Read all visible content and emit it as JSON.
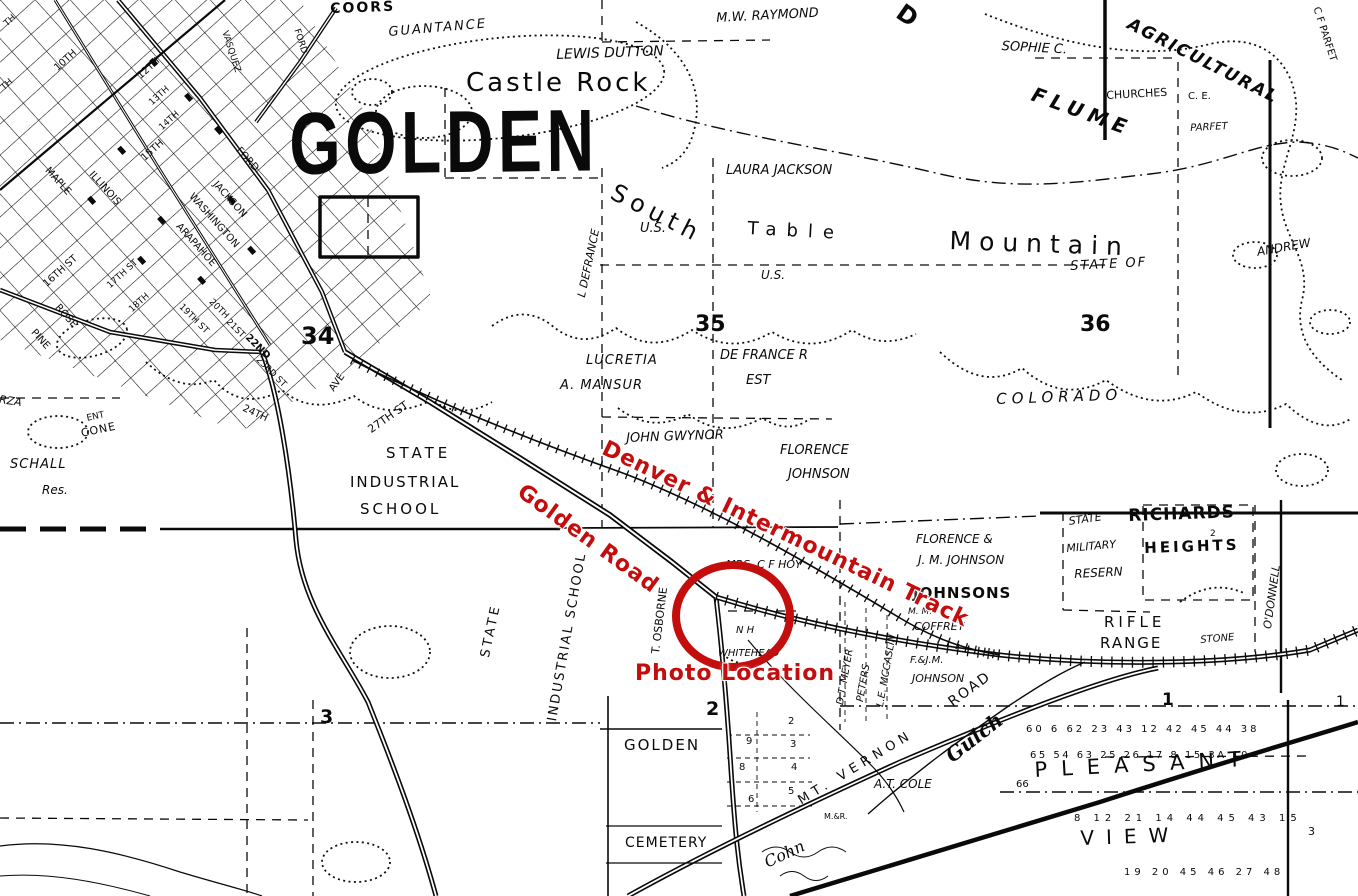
{
  "page": {
    "width": 1358,
    "height": 896,
    "background": "#ffffff",
    "ink": "#0a0a0a",
    "annotation_red": "#c40d0d"
  },
  "stamp": {
    "text": "GOLDEN"
  },
  "red_annotations": {
    "track": "Denver & Intermountain Track",
    "road": "Golden Road",
    "photo": "Photo Location",
    "circle": {
      "cx": 733,
      "cy": 616,
      "rx": 57,
      "ry": 51,
      "stroke_width": 8
    }
  },
  "labels": [
    {
      "t": "COORS",
      "x": 330,
      "y": 2,
      "s": 14,
      "w": 700,
      "ls": 2,
      "r": -2
    },
    {
      "t": "FORD",
      "x": 300,
      "y": 28,
      "s": 9,
      "r": 72
    },
    {
      "t": "VASQUEZ",
      "x": 228,
      "y": 30,
      "s": 9,
      "r": 72
    },
    {
      "t": "GUANTANCE",
      "x": 388,
      "y": 26,
      "s": 13,
      "i": 1,
      "ls": 2,
      "r": -5
    },
    {
      "t": "LEWIS DUTTON",
      "x": 556,
      "y": 48,
      "s": 14,
      "i": 1,
      "r": -2
    },
    {
      "t": "Castle Rock",
      "x": 466,
      "y": 70,
      "s": 26,
      "ls": 3
    },
    {
      "t": "M.W. RAYMOND",
      "x": 716,
      "y": 12,
      "s": 13,
      "i": 1,
      "r": -3
    },
    {
      "t": "SOPHIE C.",
      "x": 1002,
      "y": 40,
      "s": 13,
      "i": 1,
      "r": 3
    },
    {
      "t": "AGRICULTURAL",
      "x": 1132,
      "y": 16,
      "s": 17,
      "w": 600,
      "ls": 2,
      "i": 1,
      "r": 27
    },
    {
      "t": "FLUME",
      "x": 1036,
      "y": 84,
      "s": 20,
      "w": 700,
      "ls": 6,
      "i": 1,
      "r": 20
    },
    {
      "t": "CHURCHES",
      "x": 1106,
      "y": 90,
      "s": 11,
      "r": -3
    },
    {
      "t": "C. E.",
      "x": 1188,
      "y": 92,
      "s": 10
    },
    {
      "t": "PARFET",
      "x": 1190,
      "y": 124,
      "s": 10,
      "i": 1,
      "r": -3
    },
    {
      "t": "C F PARFET",
      "x": 1320,
      "y": 6,
      "s": 10,
      "r": 72
    },
    {
      "t": "D",
      "x": 906,
      "y": 0,
      "s": 24,
      "w": 700,
      "r": 35
    },
    {
      "t": "TH",
      "x": 3,
      "y": 22,
      "s": 9,
      "r": -42
    },
    {
      "t": "TH",
      "x": 0,
      "y": 86,
      "s": 9,
      "r": -42
    },
    {
      "t": "10TH",
      "x": 53,
      "y": 66,
      "s": 10,
      "r": -42
    },
    {
      "t": "12TH",
      "x": 136,
      "y": 74,
      "s": 10,
      "r": -42
    },
    {
      "t": "13TH",
      "x": 148,
      "y": 101,
      "s": 9,
      "r": -42
    },
    {
      "t": "14TH",
      "x": 158,
      "y": 126,
      "s": 9,
      "r": -42
    },
    {
      "t": "15TH",
      "x": 140,
      "y": 156,
      "s": 10,
      "r": -42
    },
    {
      "t": "MAPLE",
      "x": 50,
      "y": 166,
      "s": 10,
      "r": 48
    },
    {
      "t": "ILLINOIS",
      "x": 94,
      "y": 170,
      "s": 10,
      "r": 48
    },
    {
      "t": "WASHINGTON",
      "x": 194,
      "y": 192,
      "s": 10,
      "r": 48
    },
    {
      "t": "ARAPAHOE",
      "x": 181,
      "y": 222,
      "s": 10,
      "r": 48
    },
    {
      "t": "JACKSON",
      "x": 218,
      "y": 180,
      "s": 10,
      "r": 48
    },
    {
      "t": "FORD",
      "x": 241,
      "y": 146,
      "s": 10,
      "r": 48
    },
    {
      "t": "16TH ST",
      "x": 42,
      "y": 282,
      "s": 10,
      "r": -42
    },
    {
      "t": "17TH ST",
      "x": 106,
      "y": 284,
      "s": 9,
      "r": -42
    },
    {
      "t": "18TH",
      "x": 128,
      "y": 308,
      "s": 9,
      "r": -42
    },
    {
      "t": "ROSE",
      "x": 60,
      "y": 303,
      "s": 10,
      "r": 48
    },
    {
      "t": "PINE",
      "x": 36,
      "y": 328,
      "s": 10,
      "r": 48
    },
    {
      "t": "19TH ST",
      "x": 183,
      "y": 303,
      "s": 9,
      "r": 45
    },
    {
      "t": "20TH",
      "x": 213,
      "y": 298,
      "s": 9,
      "r": 45
    },
    {
      "t": "21ST",
      "x": 230,
      "y": 318,
      "s": 9,
      "r": 45
    },
    {
      "t": "22ND",
      "x": 250,
      "y": 333,
      "s": 10,
      "w": 600,
      "r": 45
    },
    {
      "t": "23RD ST",
      "x": 260,
      "y": 356,
      "s": 9,
      "r": 45
    },
    {
      "t": "24TH",
      "x": 245,
      "y": 404,
      "s": 10,
      "r": 25
    },
    {
      "t": "AVE",
      "x": 328,
      "y": 388,
      "s": 10,
      "r": -55
    },
    {
      "t": "27TH ST",
      "x": 366,
      "y": 426,
      "s": 11,
      "r": -35
    },
    {
      "t": "34",
      "x": 301,
      "y": 324,
      "s": 24,
      "w": 700
    },
    {
      "t": "SCHALL",
      "x": 10,
      "y": 458,
      "s": 13,
      "i": 1,
      "ls": 1
    },
    {
      "t": "Res.",
      "x": 42,
      "y": 484,
      "s": 12,
      "i": 1
    },
    {
      "t": "RZA",
      "x": 0,
      "y": 394,
      "s": 11,
      "i": 1,
      "r": 8
    },
    {
      "t": "ENT",
      "x": 86,
      "y": 415,
      "s": 9,
      "r": -12
    },
    {
      "t": "CONE",
      "x": 80,
      "y": 428,
      "s": 11,
      "ls": 1,
      "r": -12
    },
    {
      "t": "South",
      "x": 618,
      "y": 180,
      "s": 24,
      "ls": 6,
      "r": 27
    },
    {
      "t": "Table",
      "x": 748,
      "y": 220,
      "s": 18,
      "ls": 10,
      "r": 3
    },
    {
      "t": "Mountain",
      "x": 950,
      "y": 228,
      "s": 25,
      "ls": 8,
      "r": 2
    },
    {
      "t": "U.S.",
      "x": 640,
      "y": 222,
      "s": 13,
      "i": 1
    },
    {
      "t": "U.S.",
      "x": 761,
      "y": 269,
      "s": 12,
      "i": 1
    },
    {
      "t": "LAURA JACKSON",
      "x": 726,
      "y": 164,
      "s": 13,
      "i": 1
    },
    {
      "t": "STATE OF",
      "x": 1070,
      "y": 260,
      "s": 13,
      "ls": 2,
      "i": 1,
      "r": -3
    },
    {
      "t": "COLORADO",
      "x": 996,
      "y": 392,
      "s": 15,
      "ls": 5,
      "i": 1,
      "r": -2
    },
    {
      "t": "35",
      "x": 695,
      "y": 314,
      "s": 22,
      "w": 700
    },
    {
      "t": "36",
      "x": 1080,
      "y": 314,
      "s": 22,
      "w": 700
    },
    {
      "t": "L DEFRANCE",
      "x": 576,
      "y": 296,
      "s": 11,
      "i": 1,
      "r": -78
    },
    {
      "t": "LUCRETIA",
      "x": 586,
      "y": 354,
      "s": 13,
      "i": 1,
      "ls": 1
    },
    {
      "t": "A. MANSUR",
      "x": 560,
      "y": 379,
      "s": 13,
      "i": 1,
      "ls": 1
    },
    {
      "t": "DE FRANCE R",
      "x": 720,
      "y": 349,
      "s": 13,
      "i": 1
    },
    {
      "t": "EST",
      "x": 746,
      "y": 374,
      "s": 13,
      "i": 1
    },
    {
      "t": "JOHN GWYNOR",
      "x": 626,
      "y": 432,
      "s": 13,
      "i": 1,
      "r": -2
    },
    {
      "t": "FLORENCE",
      "x": 780,
      "y": 444,
      "s": 13,
      "i": 1
    },
    {
      "t": "JOHNSON",
      "x": 788,
      "y": 468,
      "s": 13,
      "i": 1
    },
    {
      "t": "ANDREW",
      "x": 1256,
      "y": 246,
      "s": 12,
      "i": 1,
      "r": -10
    },
    {
      "t": "STATE",
      "x": 386,
      "y": 446,
      "s": 15,
      "ls": 4
    },
    {
      "t": "INDUSTRIAL",
      "x": 350,
      "y": 475,
      "s": 15,
      "ls": 2
    },
    {
      "t": "SCHOOL",
      "x": 360,
      "y": 502,
      "s": 15,
      "ls": 3
    },
    {
      "t": "STATE",
      "x": 479,
      "y": 656,
      "s": 13,
      "ls": 3,
      "r": -78
    },
    {
      "t": "INDUSTRIAL SCHOOL",
      "x": 546,
      "y": 720,
      "s": 13,
      "ls": 2,
      "r": -80
    },
    {
      "t": "T. OSBORNE",
      "x": 650,
      "y": 653,
      "s": 11,
      "r": -83
    },
    {
      "t": "FLORENCE &",
      "x": 916,
      "y": 533,
      "s": 12,
      "i": 1
    },
    {
      "t": "J. M. JOHNSON",
      "x": 918,
      "y": 554,
      "s": 12,
      "i": 1
    },
    {
      "t": "JOHNSONS",
      "x": 913,
      "y": 586,
      "s": 15,
      "w": 700,
      "ls": 1
    },
    {
      "t": "M. M.",
      "x": 908,
      "y": 608,
      "s": 9,
      "i": 1
    },
    {
      "t": "COFFREY",
      "x": 914,
      "y": 621,
      "s": 11,
      "i": 1
    },
    {
      "t": "F.&J.M.",
      "x": 910,
      "y": 656,
      "s": 10,
      "i": 1
    },
    {
      "t": "JOHNSON",
      "x": 912,
      "y": 673,
      "s": 11,
      "i": 1
    },
    {
      "t": "MRS. C F HOY",
      "x": 726,
      "y": 559,
      "s": 11,
      "i": 1
    },
    {
      "t": "N H",
      "x": 736,
      "y": 626,
      "s": 10,
      "i": 1
    },
    {
      "t": "WHITEHEAD",
      "x": 718,
      "y": 649,
      "s": 10,
      "i": 1
    },
    {
      "t": "D.T. MEYER",
      "x": 836,
      "y": 704,
      "s": 10,
      "i": 1,
      "r": -80
    },
    {
      "t": "PETERS",
      "x": 856,
      "y": 701,
      "s": 10,
      "i": 1,
      "r": -80
    },
    {
      "t": "L.E. MCCASLIN",
      "x": 876,
      "y": 706,
      "s": 10,
      "i": 1,
      "r": -80
    },
    {
      "t": "STATE",
      "x": 1068,
      "y": 516,
      "s": 11,
      "i": 1,
      "r": -8
    },
    {
      "t": "MILITARY",
      "x": 1066,
      "y": 543,
      "s": 11,
      "i": 1,
      "r": -5
    },
    {
      "t": "RESERN",
      "x": 1074,
      "y": 568,
      "s": 12,
      "i": 1,
      "r": -3
    },
    {
      "t": "RICHARDS",
      "x": 1128,
      "y": 508,
      "s": 17,
      "w": 600,
      "ls": 1,
      "r": -2
    },
    {
      "t": "HEIGHTS",
      "x": 1144,
      "y": 541,
      "s": 15,
      "w": 600,
      "ls": 3,
      "r": -2
    },
    {
      "t": "2",
      "x": 1210,
      "y": 530,
      "s": 9
    },
    {
      "t": "RIFLE",
      "x": 1104,
      "y": 615,
      "s": 15,
      "ls": 4
    },
    {
      "t": "RANGE",
      "x": 1100,
      "y": 636,
      "s": 15,
      "ls": 2
    },
    {
      "t": "STONE",
      "x": 1200,
      "y": 636,
      "s": 10,
      "i": 1,
      "r": -5
    },
    {
      "t": "O'DONNELL",
      "x": 1262,
      "y": 628,
      "s": 11,
      "i": 1,
      "r": -82
    },
    {
      "t": "3",
      "x": 320,
      "y": 708,
      "s": 19,
      "w": 600
    },
    {
      "t": "2",
      "x": 706,
      "y": 700,
      "s": 19,
      "w": 600
    },
    {
      "t": "1",
      "x": 1162,
      "y": 692,
      "s": 17,
      "w": 600
    },
    {
      "t": "1",
      "x": 1336,
      "y": 695,
      "s": 14
    },
    {
      "t": "GOLDEN",
      "x": 624,
      "y": 738,
      "s": 15,
      "ls": 2
    },
    {
      "t": "CEMETERY",
      "x": 625,
      "y": 836,
      "s": 14,
      "ls": 1
    },
    {
      "t": "9",
      "x": 746,
      "y": 737,
      "s": 10
    },
    {
      "t": "8",
      "x": 739,
      "y": 763,
      "s": 10
    },
    {
      "t": "6",
      "x": 748,
      "y": 795,
      "s": 10
    },
    {
      "t": "2",
      "x": 788,
      "y": 717,
      "s": 10
    },
    {
      "t": "3",
      "x": 790,
      "y": 740,
      "s": 10
    },
    {
      "t": "4",
      "x": 791,
      "y": 763,
      "s": 10
    },
    {
      "t": "5",
      "x": 788,
      "y": 787,
      "s": 10
    },
    {
      "t": "MT. VERNON",
      "x": 796,
      "y": 796,
      "s": 13,
      "ls": 5,
      "r": -31
    },
    {
      "t": "ROAD",
      "x": 946,
      "y": 698,
      "s": 14,
      "ls": 2,
      "r": -36
    },
    {
      "t": "Gulch",
      "x": 942,
      "y": 750,
      "s": 20,
      "i": 1,
      "w": 600,
      "f": "serif",
      "r": -38
    },
    {
      "t": "Cohn",
      "x": 762,
      "y": 856,
      "s": 16,
      "i": 1,
      "f": "serif",
      "r": -25
    },
    {
      "t": "M.&R.",
      "x": 824,
      "y": 813,
      "s": 8
    },
    {
      "t": "A.T. COLE",
      "x": 874,
      "y": 778,
      "s": 12,
      "i": 1
    },
    {
      "t": "PLEASANT",
      "x": 1034,
      "y": 760,
      "s": 21,
      "ls": 14,
      "r": -3
    },
    {
      "t": "VIEW",
      "x": 1080,
      "y": 828,
      "s": 20,
      "ls": 12,
      "r": -2
    },
    {
      "t": "60 6 62 23 43 12 42 45 44 38",
      "x": 1026,
      "y": 725,
      "s": 10,
      "ls": 3
    },
    {
      "t": "65 54 63 25 26 17 8 15 3A 10",
      "x": 1030,
      "y": 751,
      "s": 10,
      "ls": 2.5
    },
    {
      "t": "8 12 21 14 44 45 43 15",
      "x": 1074,
      "y": 814,
      "s": 10,
      "ls": 5
    },
    {
      "t": "19 20 45 46 27 48",
      "x": 1124,
      "y": 868,
      "s": 10,
      "ls": 4
    },
    {
      "t": "66",
      "x": 1016,
      "y": 780,
      "s": 10
    },
    {
      "t": "3",
      "x": 1308,
      "y": 826,
      "s": 11
    }
  ]
}
